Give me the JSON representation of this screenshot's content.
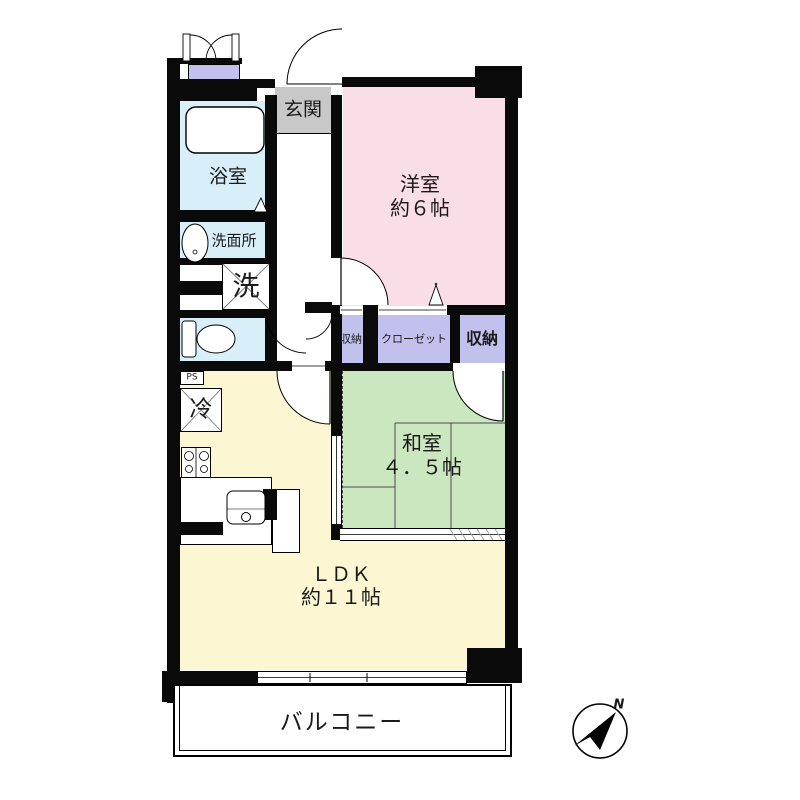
{
  "floorplan": {
    "rooms": {
      "genkan": {
        "label": "玄関"
      },
      "western": {
        "label": "洋室",
        "size": "約６帖"
      },
      "bath": {
        "label": "浴室"
      },
      "washroom": {
        "label": "洗面所"
      },
      "laundry": {
        "label": "洗"
      },
      "washitsu": {
        "label": "和室",
        "size": "４．５帖"
      },
      "ldk": {
        "label": "ＬＤＫ",
        "size": "約１１帖"
      },
      "balcony": {
        "label": "バルコニー"
      },
      "storage_left": {
        "label": "収納"
      },
      "closet": {
        "label": "クローゼット"
      },
      "storage_right": {
        "label": "収納"
      }
    },
    "fixtures": {
      "refrigerator": {
        "label": "冷"
      },
      "pipe_space": {
        "label": "PS"
      }
    },
    "compass": {
      "north": "N"
    }
  },
  "palette": {
    "genkan": "#c8c8c8",
    "western": "#f9dde7",
    "wet": "#d8eef8",
    "tatami": "#cbe7c0",
    "ldk": "#fcf6d3",
    "closet": "#c2c1ee"
  }
}
